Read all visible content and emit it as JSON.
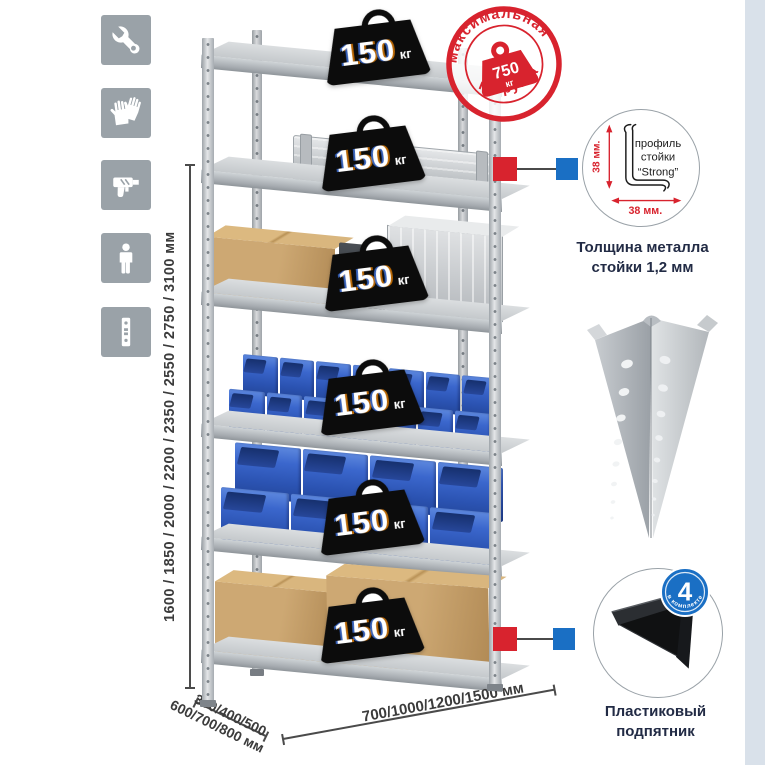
{
  "left_icons": [
    "wrench-icon",
    "gloves-icon",
    "drill-icon",
    "person-icon",
    "rack-post-icon"
  ],
  "dimensions": {
    "height": "1600 / 1850 / 2000 / 2200 / 2350 / 2550 / 2750 / 3100 мм",
    "depth_line1": "300/400/500",
    "depth_line2": "600/700/800 мм",
    "width": "700/1000/1200/1500 мм"
  },
  "stamp": {
    "arc_top": "максимальная",
    "arc_bottom": "нагрузка",
    "value": "750",
    "unit": "кг"
  },
  "shelves": [
    {
      "load": "150",
      "unit": "кг"
    },
    {
      "load": "150",
      "unit": "кг"
    },
    {
      "load": "150",
      "unit": "кг"
    },
    {
      "load": "150",
      "unit": "кг"
    },
    {
      "load": "150",
      "unit": "кг"
    },
    {
      "load": "150",
      "unit": "кг"
    }
  ],
  "profile_detail": {
    "dim_v": "38 мм.",
    "dim_h": "38 мм.",
    "label1": "профиль",
    "label2": "стойки",
    "label3": "“Strong”",
    "caption1": "Толщина металла",
    "caption2": "стойки 1,2 мм"
  },
  "foot_detail": {
    "count": "4",
    "arc": "в комплекте",
    "caption1": "Пластиковый",
    "caption2": "подпятник"
  },
  "colors": {
    "accent_red": "#d8232e",
    "accent_blue": "#1a6fc4",
    "icon_gray": "#9aa2a8",
    "bin_blue": "#2b53b2",
    "cardboard": "#cda873",
    "badge_black": "#0c0c0c"
  }
}
